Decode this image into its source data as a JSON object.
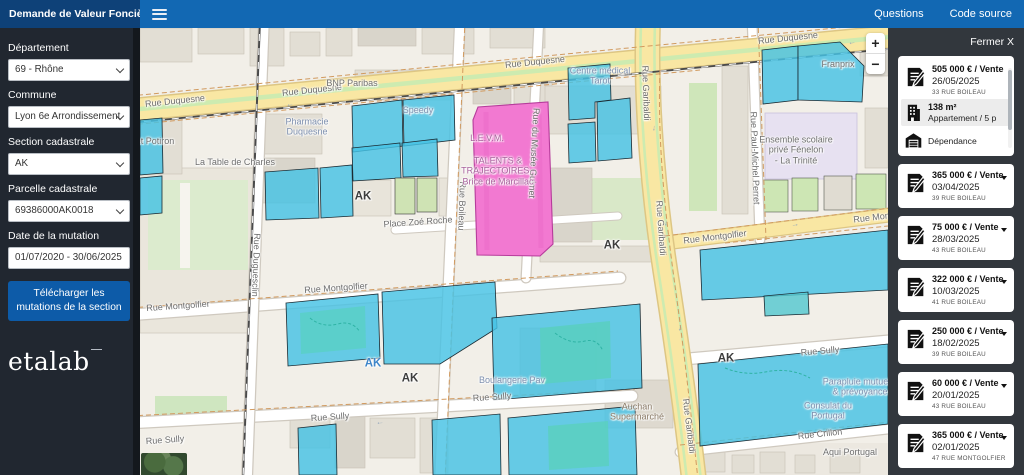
{
  "colors": {
    "topbar_blue": "#1268b3",
    "header_navy": "#0e4178",
    "button_blue": "#0d5ba8",
    "parcel_blue": "#45c2e4",
    "parcel_selected_pink": "#f279d1",
    "sidebar_dark": "#212730",
    "panel_dark": "#32373d"
  },
  "header": {
    "app_title": "Demande de Valeur Foncière",
    "menu_icon": "hamburger-icon",
    "nav": {
      "questions": "Questions",
      "code_source": "Code source"
    }
  },
  "sidebar": {
    "departement": {
      "label": "Département",
      "value": "69 - Rhône"
    },
    "commune": {
      "label": "Commune",
      "value": "Lyon 6e Arrondissement"
    },
    "section": {
      "label": "Section cadastrale",
      "value": "AK"
    },
    "parcelle": {
      "label": "Parcelle cadastrale",
      "value": "69386000AK0018"
    },
    "date": {
      "label": "Date de la mutation",
      "value": "01/07/2020 - 30/06/2025"
    },
    "download_label": "Télécharger les mutations de la section",
    "logo_text": "etalab"
  },
  "map": {
    "controls": {
      "zoom_in": "+",
      "zoom_out": "−"
    },
    "labels": [
      {
        "t": "Rue Duquesne",
        "x": 35,
        "y": 73,
        "r": -6,
        "c": "street"
      },
      {
        "t": "Rue Duquesne",
        "x": 172,
        "y": 62,
        "r": -6,
        "c": "street"
      },
      {
        "t": "Rue Duquesne",
        "x": 395,
        "y": 34,
        "r": -6,
        "c": "street"
      },
      {
        "t": "Rue Duquesne",
        "x": 648,
        "y": 10,
        "r": -6,
        "c": "street"
      },
      {
        "t": "Rue Montgolfier",
        "x": 38,
        "y": 278,
        "r": -4,
        "c": "street"
      },
      {
        "t": "Rue Montgolfier",
        "x": 196,
        "y": 260,
        "r": -4,
        "c": "street"
      },
      {
        "t": "Rue Montgolfier",
        "x": 575,
        "y": 209,
        "r": -7,
        "c": "street"
      },
      {
        "t": "Rue Montgolfier",
        "x": 745,
        "y": 188,
        "r": -7,
        "c": "street"
      },
      {
        "t": "Rue Sully",
        "x": 25,
        "y": 412,
        "r": -4,
        "c": "street"
      },
      {
        "t": "Rue Sully",
        "x": 190,
        "y": 389,
        "r": -4,
        "c": "street"
      },
      {
        "t": "Rue Sully",
        "x": 352,
        "y": 369,
        "r": -4,
        "c": "street"
      },
      {
        "t": "Rue Sully",
        "x": 680,
        "y": 323,
        "r": -5,
        "c": "street"
      },
      {
        "t": "Rue Crillon",
        "x": 680,
        "y": 406,
        "r": -6,
        "c": "street"
      },
      {
        "t": "Rue Boileau",
        "x": 322,
        "y": 178,
        "r": 92,
        "c": "street"
      },
      {
        "t": "Rue Duguesclin",
        "x": 116,
        "y": 237,
        "r": 92,
        "c": "street"
      },
      {
        "t": "Rue du Musée Guimet",
        "x": 394,
        "y": 125,
        "r": 93,
        "c": "street"
      },
      {
        "t": "Rue Paul-Michel Perret",
        "x": 615,
        "y": 130,
        "r": 88,
        "c": "street"
      },
      {
        "t": "Rue Garibaldi",
        "x": 506,
        "y": 65,
        "r": 88,
        "c": "street"
      },
      {
        "t": "Rue Garibaldi",
        "x": 521,
        "y": 200,
        "r": 86,
        "c": "street"
      },
      {
        "t": "Rue Garibaldi",
        "x": 549,
        "y": 398,
        "r": 83,
        "c": "street"
      },
      {
        "t": "BNP Paribas",
        "x": 212,
        "y": 55,
        "r": 0,
        "c": "poi"
      },
      {
        "t": "Speedy",
        "x": 278,
        "y": 82,
        "r": 0,
        "c": "shop"
      },
      {
        "t": "Pharmacie\nDuquesne",
        "x": 167,
        "y": 99,
        "r": 0,
        "c": "shop"
      },
      {
        "t": "ise et Potiron",
        "x": 8,
        "y": 113,
        "r": 0,
        "c": "poi"
      },
      {
        "t": "La Table de Charles",
        "x": 95,
        "y": 134,
        "r": 0,
        "c": "poi"
      },
      {
        "t": "Centre médical\nTarot",
        "x": 460,
        "y": 48,
        "r": 0,
        "c": "shop"
      },
      {
        "t": "Franprix",
        "x": 698,
        "y": 36,
        "r": 0,
        "c": "poi"
      },
      {
        "t": "Ensemble scolaire\nprivé Fénelon\n- La Trinité",
        "x": 656,
        "y": 122,
        "r": 0,
        "c": "poi"
      },
      {
        "t": "L.E.V.M.",
        "x": 347,
        "y": 110,
        "r": 0,
        "c": "pink"
      },
      {
        "t": "TALENTS &\nTRAJECTOIRES -\nBrice de Marcillac",
        "x": 358,
        "y": 143,
        "r": 0,
        "c": "pink"
      },
      {
        "t": "Place Zoé Roche",
        "x": 278,
        "y": 194,
        "r": -4,
        "c": "street"
      },
      {
        "t": "Boulangerie Pav",
        "x": 372,
        "y": 352,
        "r": 0,
        "c": "shop"
      },
      {
        "t": "Auchan\nSupermarché",
        "x": 497,
        "y": 384,
        "r": 0,
        "c": "amen"
      },
      {
        "t": "Consulat du\nPortugal",
        "x": 688,
        "y": 383,
        "r": 0,
        "c": "shop"
      },
      {
        "t": "Parapluie mutuelle\n& prévoyance",
        "x": 720,
        "y": 359,
        "r": 0,
        "c": "shop"
      },
      {
        "t": "Aqui Portugal",
        "x": 710,
        "y": 424,
        "r": 0,
        "c": "poi"
      },
      {
        "t": "AK",
        "x": 223,
        "y": 169,
        "r": 0,
        "c": "sec"
      },
      {
        "t": "AK",
        "x": 472,
        "y": 218,
        "r": 0,
        "c": "sec"
      },
      {
        "t": "AK",
        "x": 270,
        "y": 351,
        "r": 0,
        "c": "sec"
      },
      {
        "t": "AK",
        "x": 586,
        "y": 331,
        "r": 0,
        "c": "sec"
      },
      {
        "t": "AK",
        "x": 233,
        "y": 336,
        "r": 0,
        "c": "secb"
      },
      {
        "t": "←",
        "x": 150,
        "y": 76,
        "r": -6,
        "c": "arrow"
      },
      {
        "t": "←",
        "x": 712,
        "y": 14,
        "r": -6,
        "c": "arrow"
      },
      {
        "t": "↓",
        "x": 514,
        "y": 100,
        "r": 4,
        "c": "arrow"
      },
      {
        "t": "↓",
        "x": 526,
        "y": 195,
        "r": 6,
        "c": "arrow"
      },
      {
        "t": "↓",
        "x": 540,
        "y": 300,
        "r": 7,
        "c": "arrow"
      },
      {
        "t": "→",
        "x": 300,
        "y": 257,
        "r": -4,
        "c": "arrow"
      },
      {
        "t": "←",
        "x": 240,
        "y": 394,
        "r": -4,
        "c": "arrow"
      },
      {
        "t": "→",
        "x": 655,
        "y": 196,
        "r": -7,
        "c": "arrow"
      },
      {
        "t": "→",
        "x": 690,
        "y": 326,
        "r": -5,
        "c": "arrow"
      }
    ]
  },
  "results": {
    "close_label": "Fermer X",
    "cards": [
      {
        "icon": "mutation-icon",
        "price": "505 000 € / Vente",
        "date": "26/05/2025",
        "address": "33 RUE BOILEAU",
        "expanded": true,
        "details": [
          {
            "icon": "building-icon",
            "title": "138 m²",
            "subtitle": "Appartement / 5 p"
          },
          {
            "icon": "garage-icon",
            "title": "",
            "subtitle": "Dépendance"
          }
        ]
      },
      {
        "icon": "mutation-icon",
        "price": "365 000 € / Vente",
        "date": "03/04/2025",
        "address": "39 RUE BOILEAU"
      },
      {
        "icon": "mutation-icon",
        "price": "75 000 € / Vente",
        "date": "28/03/2025",
        "address": "43 RUE BOILEAU"
      },
      {
        "icon": "mutation-icon",
        "price": "322 000 € / Vente",
        "date": "10/03/2025",
        "address": "41 RUE BOILEAU"
      },
      {
        "icon": "mutation-icon",
        "price": "250 000 € / Vente",
        "date": "18/02/2025",
        "address": "39 RUE BOILEAU"
      },
      {
        "icon": "mutation-icon",
        "price": "60 000 € / Vente",
        "date": "20/01/2025",
        "address": "43 RUE BOILEAU"
      },
      {
        "icon": "mutation-icon",
        "price": "365 000 € / Vente",
        "date": "02/01/2025",
        "address": "47 RUE MONTGOLFIER"
      }
    ]
  }
}
